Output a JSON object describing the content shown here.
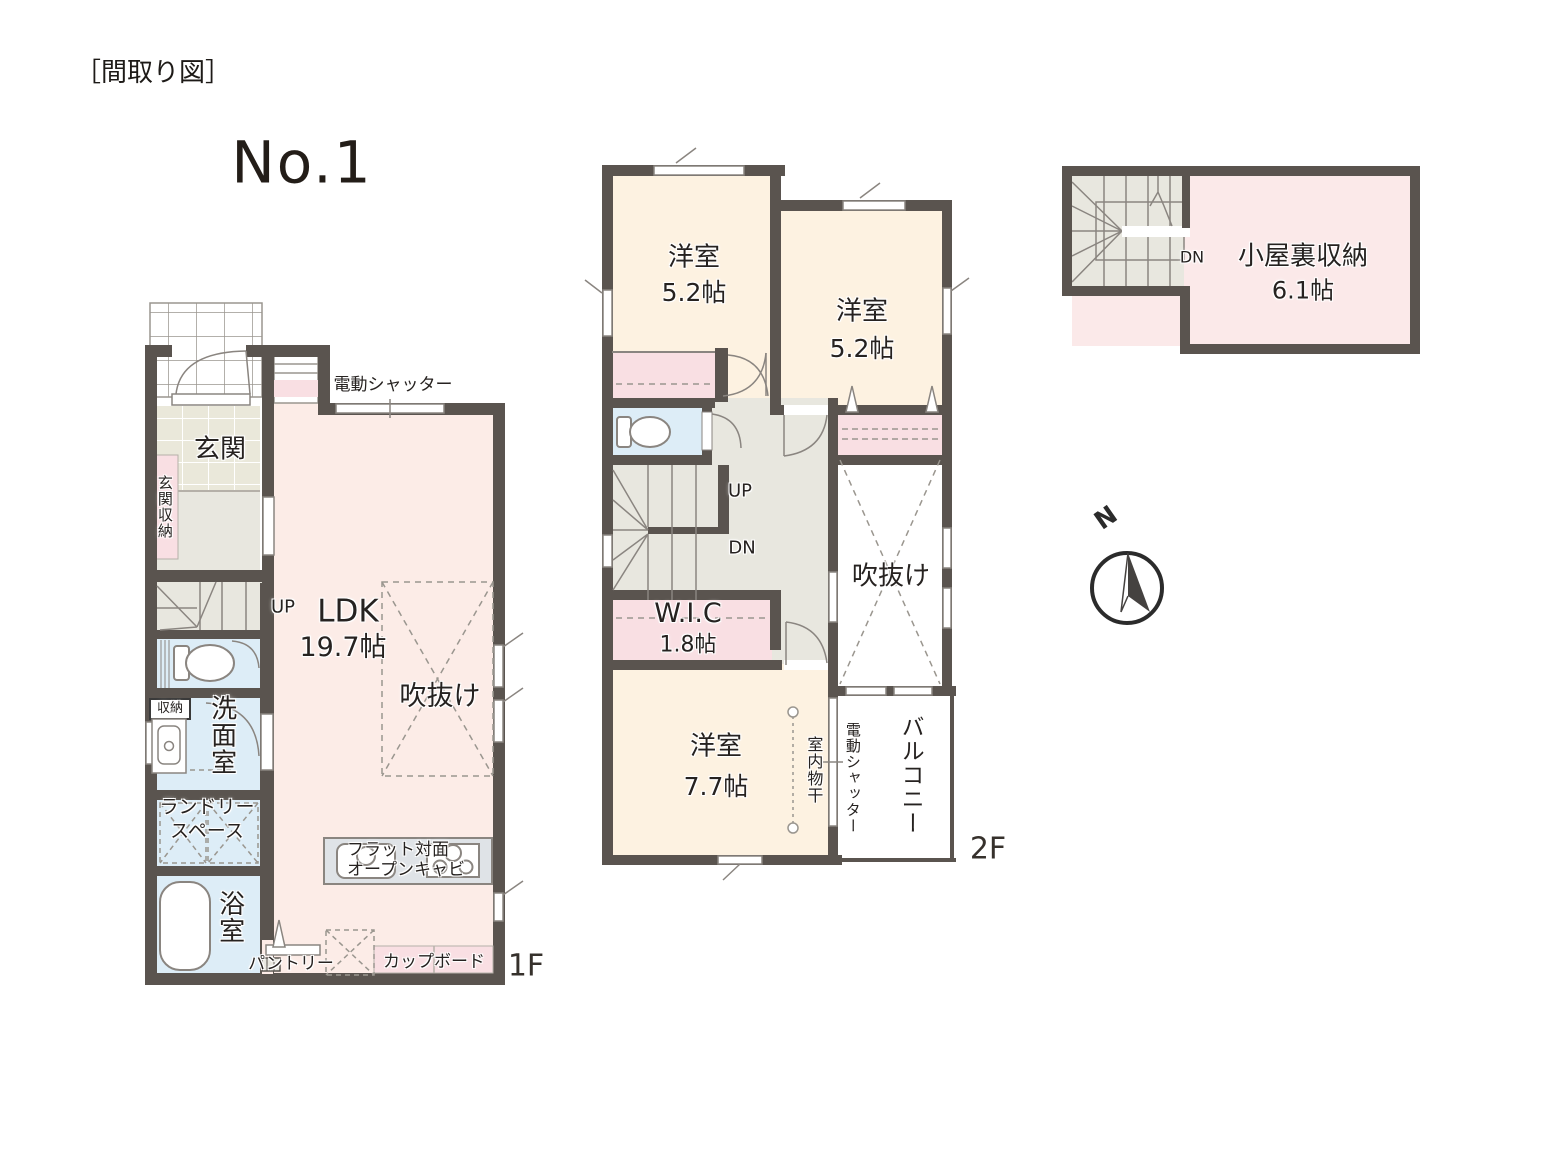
{
  "title": "［間取り図］",
  "plan_number": "No.1",
  "compass_north": "N",
  "colors": {
    "wall": "#5a544f",
    "room_ldk": "#fcece7",
    "room_cream": "#fdf2e1",
    "room_blue": "#ddedf7",
    "room_pink": "#f9dfe3",
    "room_gray": "#e8e7df",
    "room_attic": "#fbe9e9",
    "kitchen_counter": "#dfe3e7"
  },
  "floor1": {
    "floor_label": "1F",
    "shutter": "電動シャッター",
    "entrance": "玄関",
    "entrance_storage": "玄関収納",
    "stairs_up": "UP",
    "ldk_name": "LDK",
    "ldk_size": "19.7帖",
    "void": "吹抜け",
    "storage": "収納",
    "washroom": "洗面室",
    "laundry_line1": "ランドリー",
    "laundry_line2": "スペース",
    "bathroom": "浴室",
    "pantry": "パントリー",
    "cupboard": "カップボード",
    "kitchen_note_line1": "フラット対面",
    "kitchen_note_line2": "オープンキャビ"
  },
  "floor2": {
    "floor_label": "2F",
    "bedroom1_name": "洋室",
    "bedroom1_size": "5.2帖",
    "bedroom2_name": "洋室",
    "bedroom2_size": "5.2帖",
    "bedroom3_name": "洋室",
    "bedroom3_size": "7.7帖",
    "stairs_up": "UP",
    "stairs_down": "DN",
    "wic_name": "W.I.C",
    "wic_size": "1.8帖",
    "void": "吹抜け",
    "indoor_drying": "室内物干",
    "shutter": "電動シャッター",
    "balcony": "バルコニー"
  },
  "attic": {
    "name": "小屋裏収納",
    "size": "6.1帖",
    "stairs_down": "DN"
  }
}
